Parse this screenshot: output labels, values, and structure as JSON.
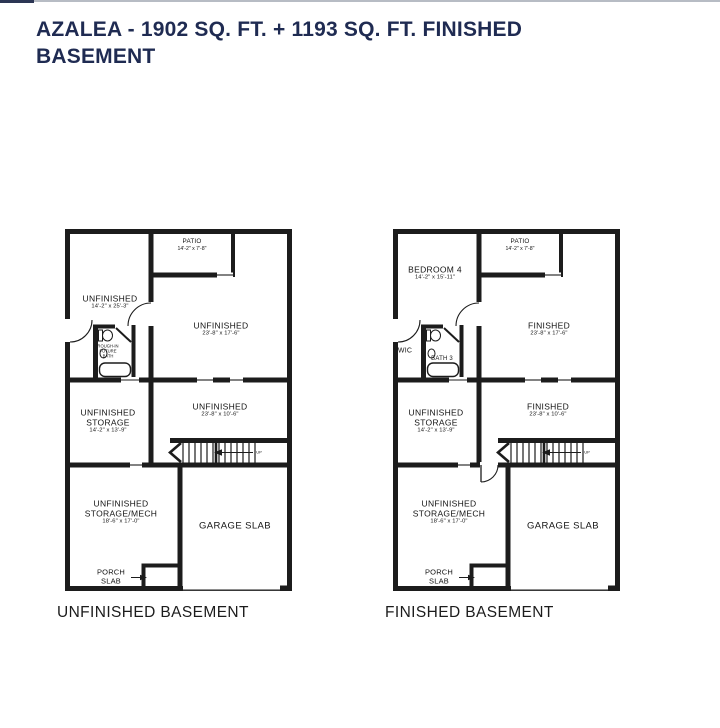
{
  "header": {
    "title_line1": "AZALEA - 1902 SQ. FT. + 1193 SQ. FT. FINISHED",
    "title_line2": "BASEMENT"
  },
  "colors": {
    "title": "#1f2b52",
    "wall": "#1c1c1c",
    "top_border": "#b7bcc4"
  },
  "plans": [
    {
      "caption": "UNFINISHED BASEMENT",
      "stairs_label": "UP",
      "rooms": {
        "patio": {
          "name": "PATIO",
          "dims": "14'-2\" x 7'-8\""
        },
        "upper_left": {
          "name": "UNFINISHED",
          "dims": "14'-2\" x 25'-3\""
        },
        "upper_right": {
          "name": "UNFINISHED",
          "dims": "23'-8\" x 17'-6\""
        },
        "bath": {
          "line1": "ROUGH-IN",
          "line2": "FUTURE",
          "line3": "BATH"
        },
        "storage": {
          "name": "UNFINISHED",
          "name2": "STORAGE",
          "dims": "14'-2\" x 13'-9\""
        },
        "middle_right": {
          "name": "UNFINISHED",
          "dims": "23'-8\" x 10'-6\""
        },
        "storage_mech": {
          "name": "UNFINISHED",
          "name2": "STORAGE/MECH",
          "dims": "18'-6\" x 17'-0\""
        },
        "garage": {
          "name": "GARAGE SLAB"
        },
        "porch": {
          "line1": "PORCH",
          "line2": "SLAB"
        }
      }
    },
    {
      "caption": "FINISHED BASEMENT",
      "stairs_label": "UP",
      "rooms": {
        "patio": {
          "name": "PATIO",
          "dims": "14'-2\" x 7'-8\""
        },
        "bedroom": {
          "name": "BEDROOM 4",
          "dims": "14'-2\" x 15'-11\""
        },
        "upper_right": {
          "name": "FINISHED",
          "dims": "23'-8\" x 17'-6\""
        },
        "wic": {
          "name": "WIC"
        },
        "bath": {
          "name": "BATH 3"
        },
        "storage": {
          "name": "UNFINISHED",
          "name2": "STORAGE",
          "dims": "14'-2\" x 13'-9\""
        },
        "middle_right": {
          "name": "FINISHED",
          "dims": "23'-8\" x 10'-6\""
        },
        "storage_mech": {
          "name": "UNFINISHED",
          "name2": "STORAGE/MECH",
          "dims": "18'-6\" x 17'-0\""
        },
        "garage": {
          "name": "GARAGE SLAB"
        },
        "porch": {
          "line1": "PORCH",
          "line2": "SLAB"
        }
      }
    }
  ]
}
